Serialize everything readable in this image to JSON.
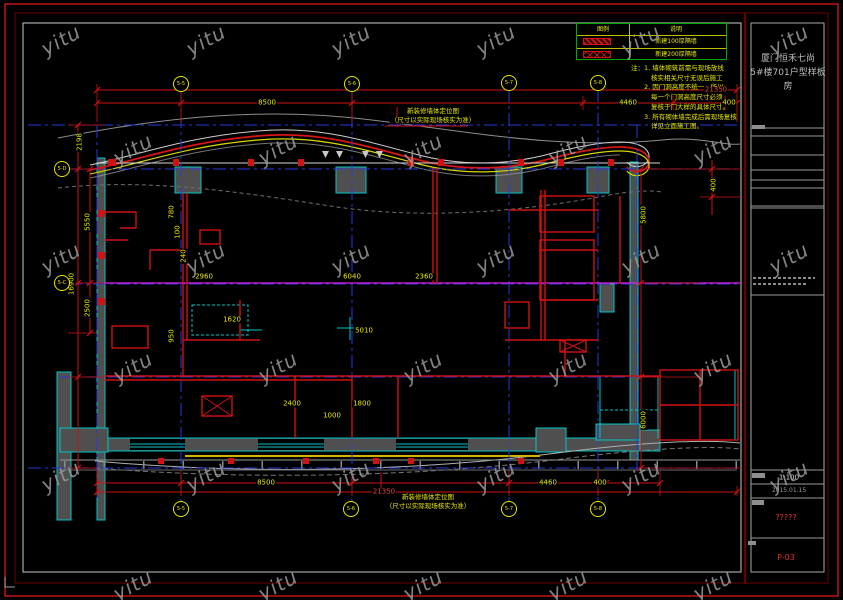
{
  "sheet": {
    "project_line1": "厦门恒禾七尚",
    "project_line2": "5#楼701户型样板房",
    "scale": "1:100",
    "date": "2015.01.15",
    "sheet_name_glyphs": "?????",
    "sheet_no": "P-03"
  },
  "legend": {
    "col_symbol": "图例",
    "col_desc": "说明",
    "rows": [
      {
        "swatch": "diagonal-hatch",
        "desc": "新建100厚隔墙"
      },
      {
        "swatch": "cross-hatch",
        "desc": "新建200厚隔墙"
      }
    ]
  },
  "notes": {
    "lines": [
      "注：1. 墙体砌筑前需与现场放线",
      "核实相关尺寸无误后施工",
      "2. 因门洞高度不统一，所以",
      "每一个门洞高度尺寸必须",
      "复核于门大样的具体尺寸。",
      "3. 所有砌体墙完成后需现场复核",
      "详见立面施工图。"
    ]
  },
  "captions": {
    "top1": "新装修墙体定位图",
    "top2": "（尺寸以实际现场核实为准）",
    "bottom1": "新装修墙体定位图",
    "bottom2": "（尺寸以实际现场核实为准）"
  },
  "bubbles": {
    "top": [
      "5-5",
      "5-6",
      "5-7",
      "5-8"
    ],
    "bottom": [
      "5-5",
      "5-6",
      "5-7",
      "5-8"
    ],
    "left": [
      "5-D",
      "5-C"
    ]
  },
  "dims": {
    "top_overall": "21350",
    "top_segments": [
      "8500",
      "4460",
      "400"
    ],
    "bottom_overall": "21350",
    "bottom_segments": [
      "8500",
      "4460",
      "400"
    ],
    "left": [
      "2198",
      "5550",
      "16900",
      "2500"
    ],
    "right": [
      "5800",
      "6000",
      "400"
    ],
    "interior": [
      "2960",
      "6040",
      "2360",
      "1620",
      "5010",
      "2400",
      "1800",
      "1000",
      "780",
      "100",
      "240",
      "950"
    ]
  },
  "watermark": {
    "text": "yitu"
  },
  "colors": {
    "grid_blue": "#2838d8",
    "dim_red": "#cf1212",
    "text_yellow": "#e8e800",
    "wall_cyan": "#00c4c4",
    "magenta": "#e020e0",
    "frame_red": "#c11212",
    "legend_green": "#00aa00",
    "sheet_no_red": "#e03030"
  }
}
